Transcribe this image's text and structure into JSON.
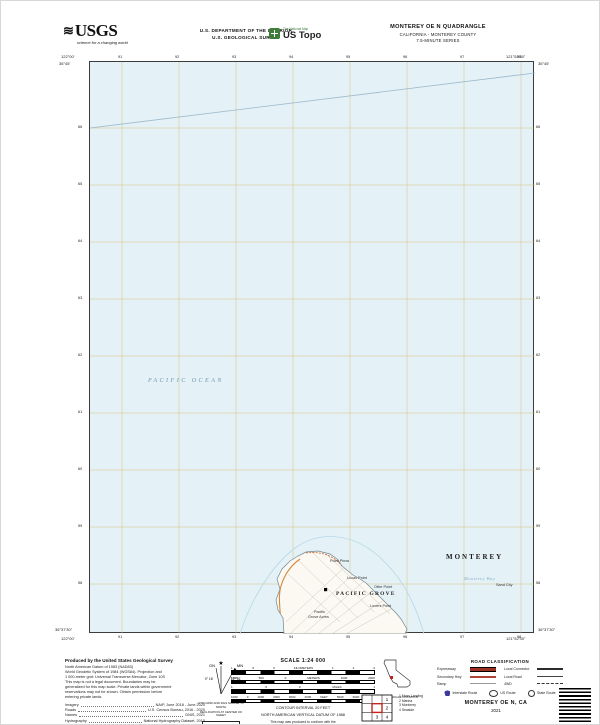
{
  "header": {
    "usgs_wave": "≋",
    "usgs_wordmark": "USGS",
    "usgs_tagline": "science for a changing world",
    "dept_line1": "U.S. DEPARTMENT OF THE INTERIOR",
    "dept_line2": "U.S. GEOLOGICAL SURVEY",
    "ustopo_top": "The National Map",
    "ustopo_name": "US Topo",
    "quad_title": "MONTEREY OE N QUADRANGLE",
    "quad_state": "CALIFORNIA - MONTEREY COUNTY",
    "quad_series": "7.5-MINUTE SERIES"
  },
  "map": {
    "ocean_color": "#e4f1f7",
    "grid_color": "#d8c27c",
    "labels": [
      {
        "text": "PACIFIC OCEAN",
        "x": 58,
        "y": 316,
        "cls": "lbl-ocean"
      },
      {
        "text": "MONTEREY",
        "x": 356,
        "y": 491,
        "cls": "lbl-city-big"
      },
      {
        "text": "Monterey Bay",
        "x": 374,
        "y": 514,
        "cls": "lbl-bay"
      },
      {
        "text": "Sand City",
        "x": 406,
        "y": 521,
        "cls": "lbl-place"
      },
      {
        "text": "Point Pinos",
        "x": 240,
        "y": 497,
        "cls": "lbl-place"
      },
      {
        "text": "Lucas Point",
        "x": 257,
        "y": 514,
        "cls": "lbl-place"
      },
      {
        "text": "Otter Point",
        "x": 284,
        "y": 523,
        "cls": "lbl-place"
      },
      {
        "text": "Lovers Point",
        "x": 280,
        "y": 542,
        "cls": "lbl-place"
      },
      {
        "text": "PACIFIC GROVE",
        "x": 246,
        "y": 529,
        "cls": "lbl-town"
      },
      {
        "text": "Pacific",
        "x": 224,
        "y": 548,
        "cls": "lbl-place"
      },
      {
        "text": "Grove Acres",
        "x": 218,
        "y": 553,
        "cls": "lbl-place"
      }
    ],
    "corners": {
      "tl_lon": "122°00'",
      "tl_lat": "36°45'",
      "tr_lon": "121°52'30\"",
      "tr_lat": "36°45'",
      "bl_lon": "122°00'",
      "bl_lat": "36°37'30\"",
      "br_lon": "121°52'30\"",
      "br_lat": "36°37'30\""
    },
    "top_ticks": [
      "91",
      "92",
      "93",
      "94",
      "95",
      "96",
      "97",
      "98"
    ],
    "bottom_ticks": [
      "91",
      "92",
      "93",
      "94",
      "95",
      "96",
      "97",
      "98"
    ],
    "left_ticks": [
      "66",
      "65",
      "64",
      "63",
      "62",
      "61",
      "60",
      "59",
      "58"
    ],
    "right_ticks": [
      "66",
      "65",
      "64",
      "63",
      "62",
      "61",
      "60",
      "59",
      "58"
    ]
  },
  "notes": {
    "heading": "Produced by the United States Geological Survey",
    "lines": [
      "North American Datum of 1983 (NAD83)",
      "World Geodetic System of 1984 (WGS84).  Projection and",
      "1 000-meter grid: Universal Transverse Mercator, Zone 10S",
      "This map is not a legal document. Boundaries may be",
      "generalized for this map scale. Private lands within government",
      "reservations may not be shown. Obtain permission before",
      "entering private lands."
    ],
    "sources": [
      {
        "label": "Imagery",
        "value": "NAIP, June 2018 - June 2020"
      },
      {
        "label": "Roads",
        "value": "U.S. Census Bureau, 2016 - 2020"
      },
      {
        "label": "Names",
        "value": "GNIS, 2021"
      },
      {
        "label": "Hydrography",
        "value": "National Hydrography Dataset, 2015"
      },
      {
        "label": "Contours",
        "value": "National Elevation Dataset, 2021"
      },
      {
        "label": "Boundaries",
        "value": "Multiple sources; see metadata file 2018 - 2021"
      }
    ]
  },
  "declination": {
    "star": "★",
    "gn_label": "GN",
    "mn_label": "MN",
    "gn_angle": "0° 16'",
    "mn_angle": "12° 51'",
    "caption1": "UTM GRID AND 2021 MAGNETIC NORTH",
    "caption2": "DECLINATION AT CENTER OF SHEET",
    "usng_title": "U.S. National Grid",
    "usng_sub": "100,000-m Square ID",
    "usng_cells": [
      "FE",
      "GE"
    ],
    "zone_label": "Grid Zone Designation",
    "zone": "10S"
  },
  "scale": {
    "title": "SCALE 1:24 000",
    "bars": [
      {
        "cells": [
          "1",
          ".5",
          "0",
          "KILOMETERS",
          "1",
          "2",
          "3"
        ]
      },
      {
        "cells": [
          "1000",
          "500",
          "0",
          "METERS",
          "1000",
          "2000"
        ]
      },
      {
        "cells": [
          "1",
          ".5",
          "0",
          "MILES",
          "1"
        ]
      },
      {
        "cells": [
          "1000",
          "0",
          "1000",
          "2000",
          "3000",
          "4000",
          "FEET",
          "5000",
          "6000",
          "7000"
        ]
      }
    ],
    "contour1": "CONTOUR INTERVAL 20 FEET",
    "contour2": "NORTH AMERICAN VERTICAL DATUM OF 1988",
    "std1": "This map was produced to conform with the",
    "std2": "National Geospatial Program US Topo Product Standard, 2021."
  },
  "location": {
    "caption": "QUADRANGLE LOCATION"
  },
  "adjoining": {
    "caption": "ADJOINING QUADRANGLES",
    "cells": [
      "1",
      "2",
      "3",
      "4"
    ],
    "items": [
      "1  Moss Landing",
      "2  Marina",
      "3  Monterey",
      "4  Seaside"
    ]
  },
  "legend": {
    "title": "ROAD CLASSIFICATION",
    "rows": [
      {
        "label": "Expressway",
        "style": "expressway"
      },
      {
        "label": "Local Connector",
        "style": "connector"
      },
      {
        "label": "Secondary Hwy",
        "style": "secondary"
      },
      {
        "label": "Local Road",
        "style": "local"
      },
      {
        "label": "Ramp",
        "style": "ramp"
      },
      {
        "label": "4WD",
        "style": "fourwd"
      }
    ],
    "shields": [
      {
        "type": "interstate",
        "label": "Interstate Route"
      },
      {
        "type": "us",
        "label": "US Route"
      },
      {
        "type": "state",
        "label": "State Route"
      }
    ]
  },
  "footer": {
    "title": "MONTEREY OE N, CA",
    "year": "2021"
  }
}
